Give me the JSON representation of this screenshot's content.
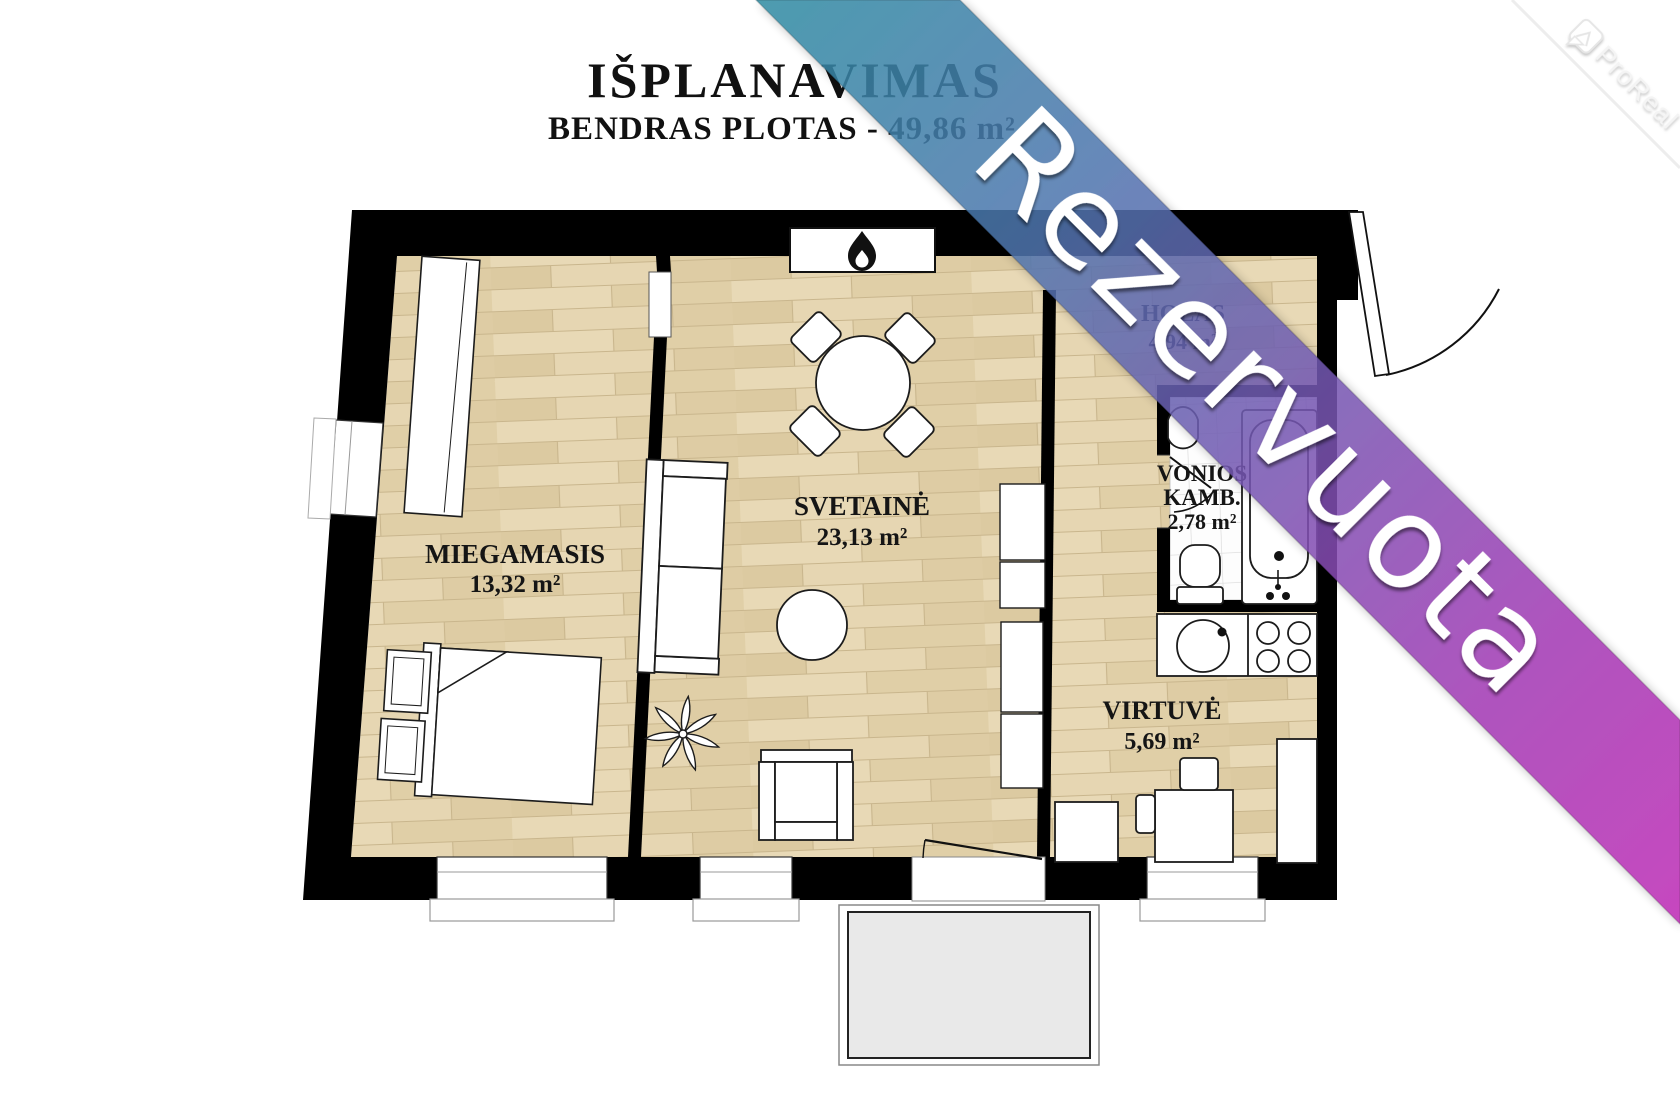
{
  "title": {
    "main": "IŠPLANAVIMAS",
    "subtitle": "BENDRAS PLOTAS - 49,86 m²"
  },
  "banner": {
    "label": "Rezervuota",
    "colors": [
      "#2f8ca3",
      "#4e76ae",
      "#7557b2",
      "#a03ab4",
      "#be2bb5"
    ]
  },
  "watermark": {
    "label": "ProReal"
  },
  "plan": {
    "total_area": "49,86 m²",
    "wall_color": "#000000",
    "floor_color": "#e3d3ad",
    "tile_color": "#ffffff",
    "balcony_color": "#e9e9e9",
    "rooms": [
      {
        "name": "MIEGAMASIS",
        "area": "13,32 m²"
      },
      {
        "name": "SVETAINĖ",
        "area": "23,13 m²"
      },
      {
        "name": "HOLAS",
        "area": "4,94 m²"
      },
      {
        "name": "VONIOS",
        "name2": "KAMB.",
        "area": "2,78 m²"
      },
      {
        "name": "VIRTUVĖ",
        "area": "5,69 m²"
      }
    ]
  }
}
